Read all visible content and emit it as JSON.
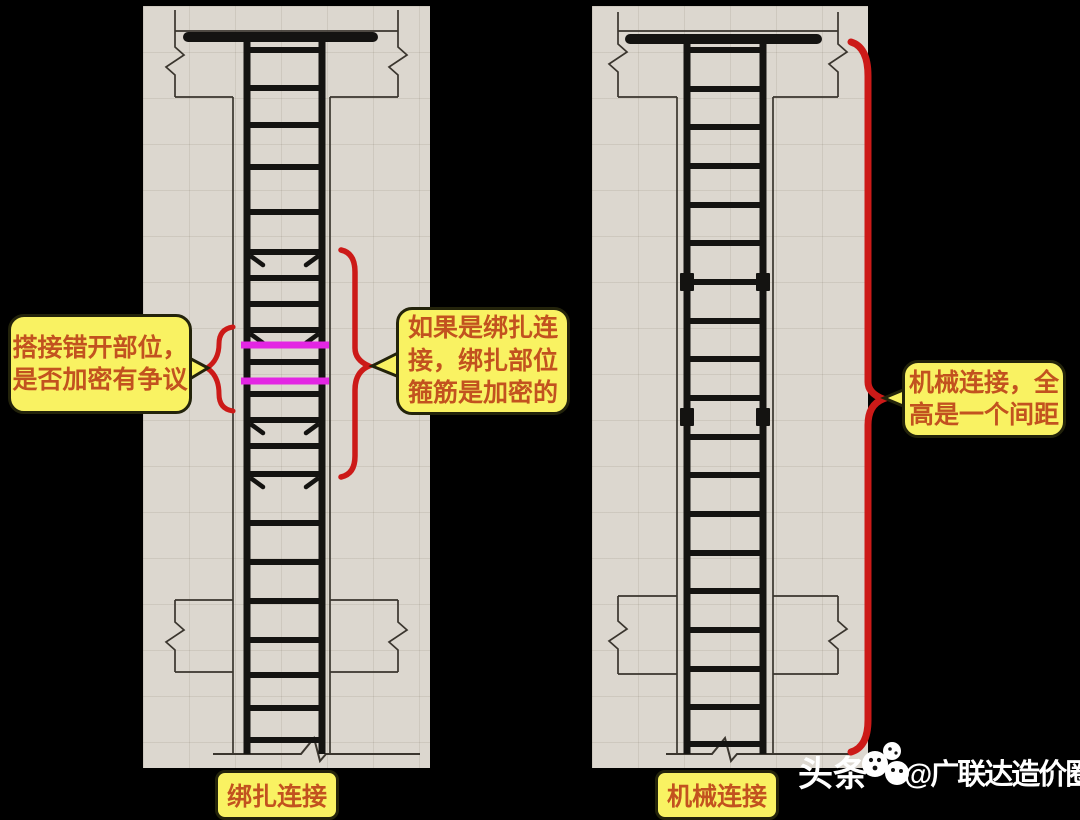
{
  "colors": {
    "background": "#000000",
    "panel_bg": "#dcd7cf",
    "line": "#141311",
    "thin_line": "#3a352e",
    "splice_highlight": "#e326e3",
    "annotation_red": "#cc1a18",
    "callout_bg": "#f9f262",
    "callout_border": "#23230b",
    "callout_text": "#c2521f",
    "watermark_text": "#ffffff"
  },
  "callouts": {
    "lap_zone": {
      "lines": [
        "搭接错开部位，",
        "是否加密有争议"
      ]
    },
    "tied_connection": {
      "lines": [
        "如果是绑扎连",
        "接，绑扎部位",
        "箍筋是加密的"
      ]
    },
    "mechanical_connection": {
      "lines": [
        "机械连接，全",
        "高是一个间距"
      ]
    }
  },
  "captions": {
    "left": "绑扎连接",
    "right": "机械连接"
  },
  "watermark": {
    "prefix": "头条",
    "logo": "toutiao-logo",
    "handle": "@广联达造价圈"
  },
  "diagrams": {
    "left": {
      "name": "lap-splice-column",
      "connection_type": "绑扎连接 (tied lap splice)",
      "w": 287,
      "h": 762,
      "top_line_y": 25,
      "bar": {
        "y": 31,
        "x1": 45,
        "x2": 230
      },
      "outer_x": [
        32,
        255
      ],
      "outer_top": {
        "y1": 4,
        "y2": 91,
        "break": 55
      },
      "shaft_x": [
        90,
        187
      ],
      "col_x": [
        104,
        179
      ],
      "col_top": 31,
      "slab_top_y": 91,
      "bottom": {
        "upper_y": 594,
        "lower_y": 666,
        "break": 630
      },
      "ground": {
        "y": 748,
        "x1": 70,
        "x2": 277,
        "zig": 166
      },
      "stirrup_ys": [
        44,
        82,
        119,
        161,
        206,
        246,
        272,
        298,
        324,
        356,
        388,
        414,
        440,
        468,
        517,
        556,
        595,
        634,
        669,
        702,
        734
      ],
      "hooked_stirrup_ys": [
        246,
        324,
        414,
        468
      ],
      "splice_bar_ys": [
        339,
        375
      ],
      "coupler_ys": []
    },
    "right": {
      "name": "mechanical-splice-column",
      "connection_type": "机械连接 (mechanical splice)",
      "w": 276,
      "h": 762,
      "top_line_y": 25,
      "bar": {
        "y": 33,
        "x1": 38,
        "x2": 225
      },
      "outer_x": [
        26,
        246
      ],
      "outer_top": {
        "y1": 6,
        "y2": 91,
        "break": 52
      },
      "shaft_x": [
        85,
        181
      ],
      "col_x": [
        95,
        171
      ],
      "col_top": 33,
      "slab_top_y": 91,
      "bottom": {
        "upper_y": 590,
        "lower_y": 668,
        "break": 629
      },
      "ground": {
        "y": 748,
        "x1": 74,
        "x2": 261,
        "zig": 128
      },
      "stirrup_ys": [
        44,
        83,
        121,
        160,
        199,
        237,
        276,
        315,
        353,
        392,
        431,
        469,
        508,
        547,
        585,
        624,
        663,
        701,
        738
      ],
      "hooked_stirrup_ys": [],
      "splice_bar_ys": [],
      "coupler_ys": [
        276,
        411
      ]
    }
  }
}
